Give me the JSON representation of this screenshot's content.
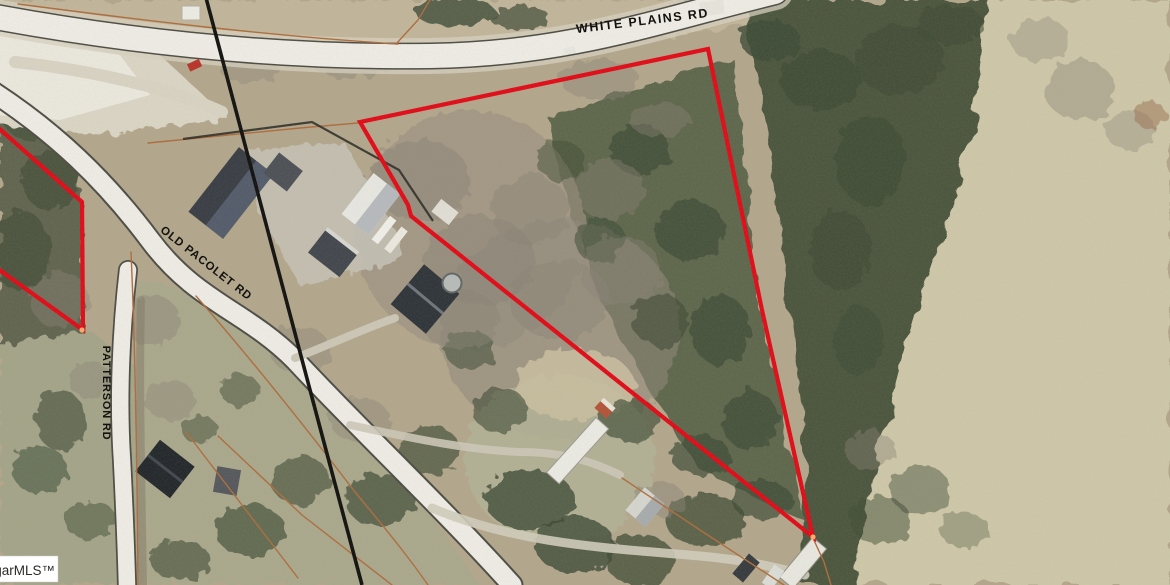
{
  "map": {
    "labels": {
      "white_plains": "WHITE PLAINS RD",
      "old_pacolet": "OLD PACOLET RD",
      "patterson": "PATTERSON RD"
    },
    "watermark": "garMLS™",
    "colors": {
      "subject_parcel_outline": "#e30613",
      "parcel_lines": "#ad6b3a",
      "survey_line": "#0d0d0b",
      "road_fill": "#f0eee7"
    },
    "parcels": {
      "subject": {
        "points": "360,122 708,49 762,310 813,537 411,216 408,205"
      },
      "west_neighbor": {
        "points": "-6,124 82,202 83,330 -6,266"
      }
    },
    "survey_line_points": "205,-6 318,420 362,585"
  }
}
